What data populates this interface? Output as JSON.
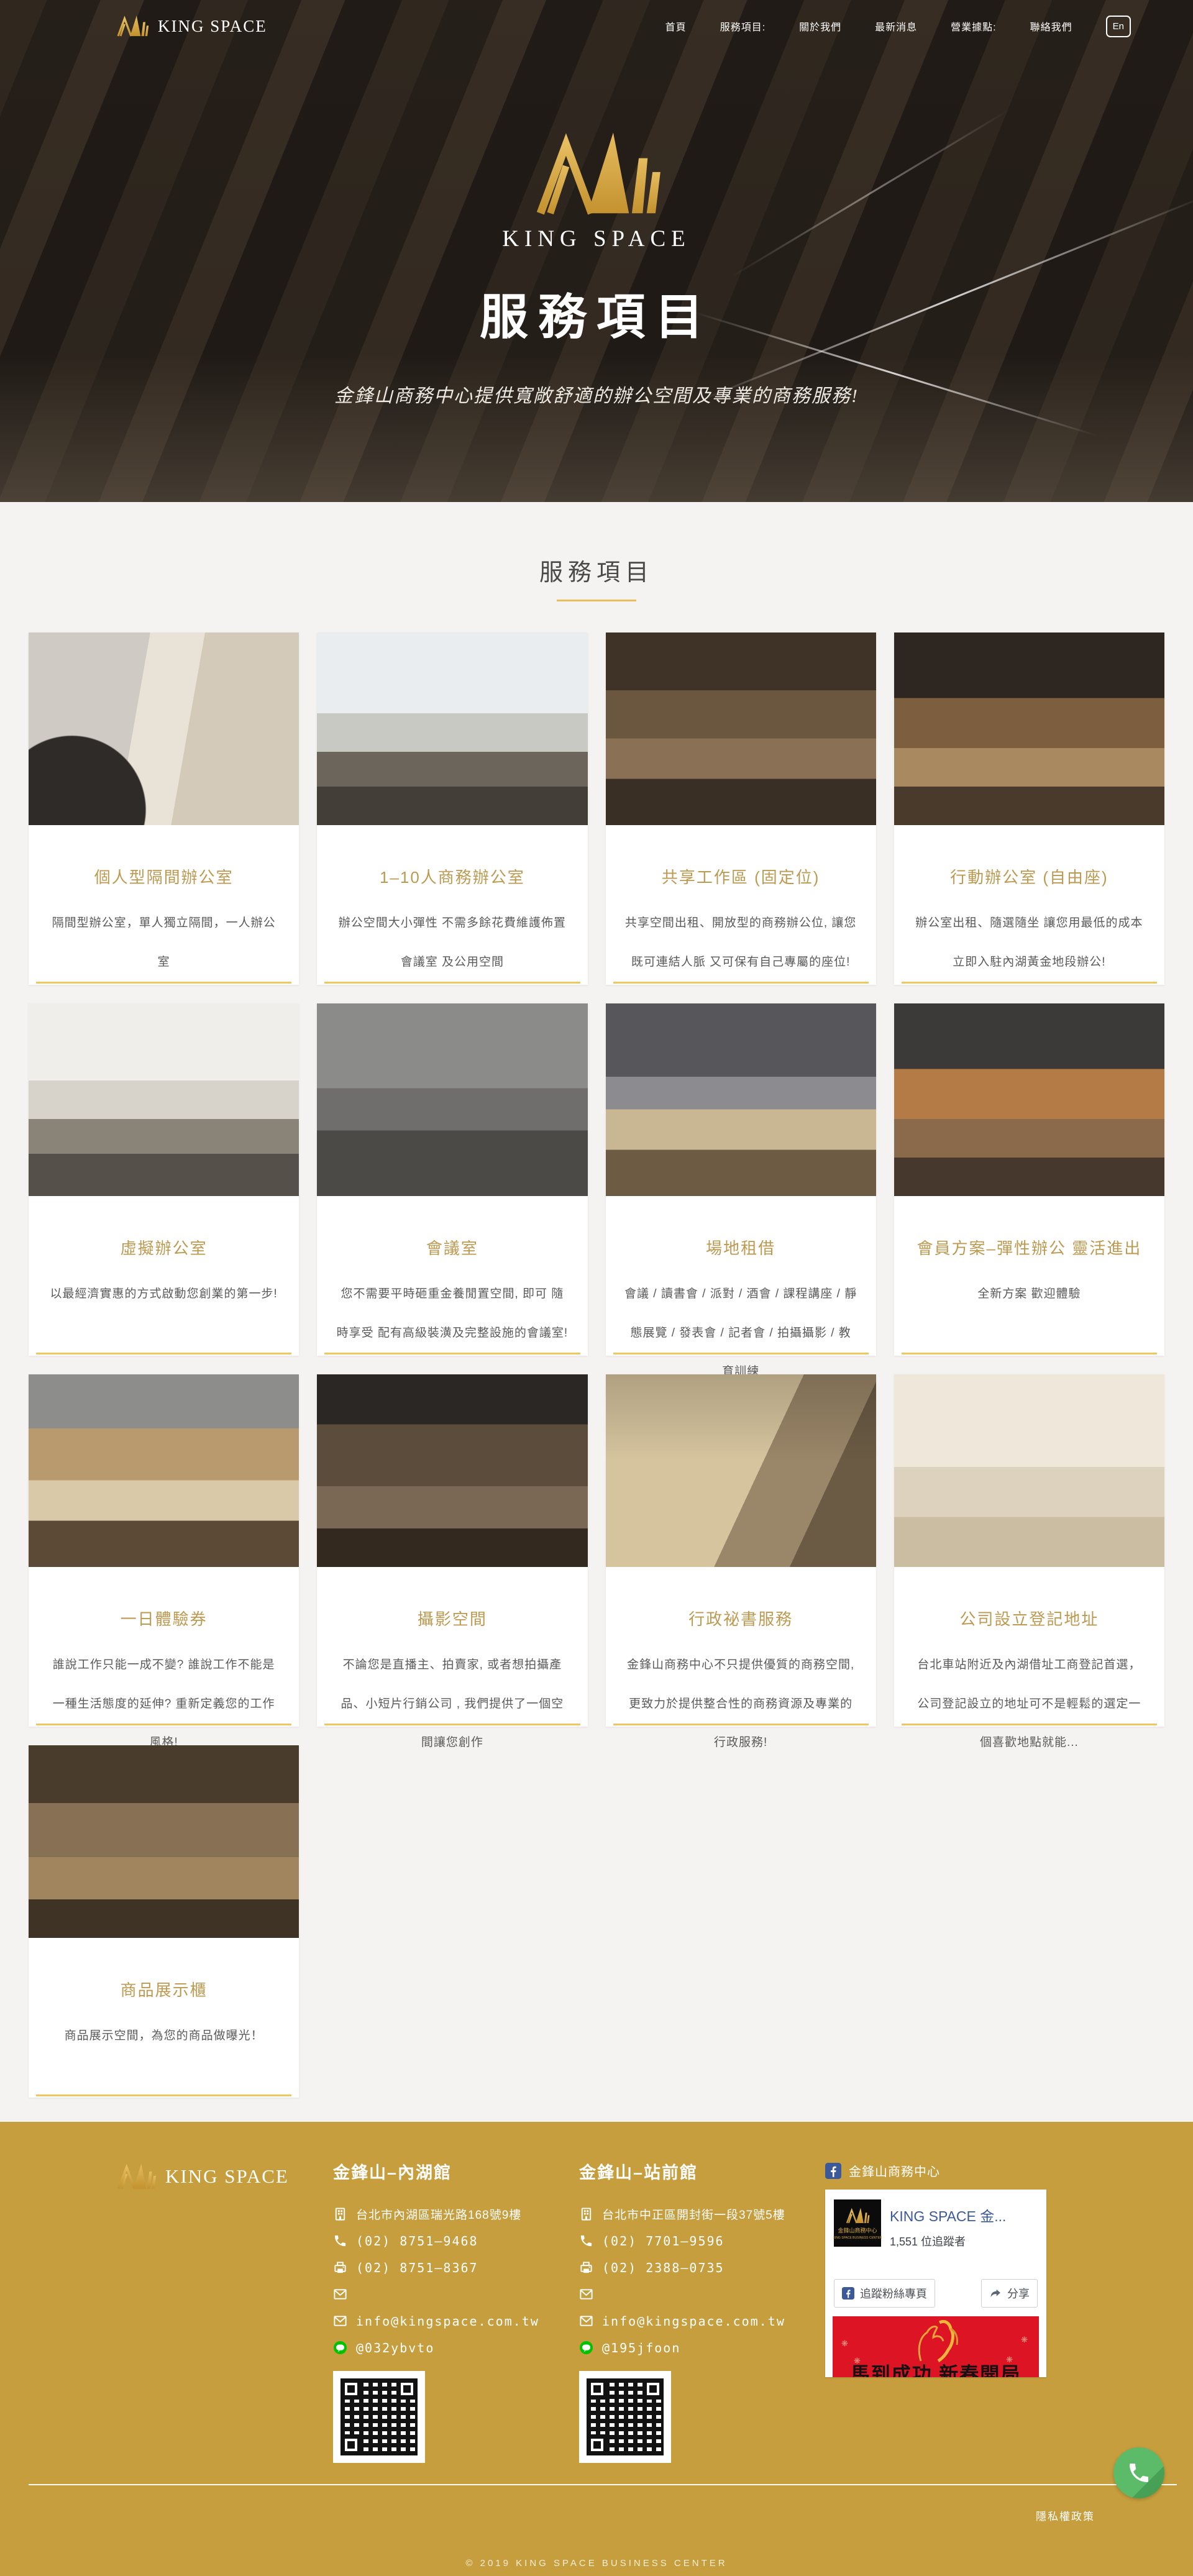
{
  "nav": {
    "brand": "KING SPACE",
    "items": [
      "首頁",
      "服務項目:",
      "關於我們",
      "最新消息",
      "營業據點:",
      "聯絡我們"
    ],
    "lang_button": "En"
  },
  "hero": {
    "brand": "KING SPACE",
    "title": "服務項目",
    "subtitle": "金鋒山商務中心提供寬敞舒適的辦公空間及專業的商務服務!"
  },
  "services": {
    "section_title": "服務項目",
    "cards": [
      {
        "title": "個人型隔間辦公室",
        "desc": "隔間型辦公室，單人獨立隔間，一人辦公室"
      },
      {
        "title": "1–10人商務辦公室",
        "desc": "辦公空間大小彈性 不需多餘花費維護佈置會議室 及公用空間"
      },
      {
        "title": "共享工作區 (固定位)",
        "desc": "共享空間出租、開放型的商務辦公位, 讓您既可連結人脈 又可保有自己專屬的座位!"
      },
      {
        "title": "行動辦公室 (自由座)",
        "desc": "辦公室出租、隨選隨坐 讓您用最低的成本 立即入駐內湖黃金地段辦公!"
      },
      {
        "title": "虛擬辦公室",
        "desc": "以最經濟實惠的方式啟動您創業的第一步!"
      },
      {
        "title": "會議室",
        "desc": "您不需要平時砸重金養閒置空間, 即可 隨時享受 配有高級裝潢及完整設施的會議室!"
      },
      {
        "title": "場地租借",
        "desc": "會議 / 讀書會 / 派對 / 酒會 / 課程講座 / 靜態展覽 / 發表會 / 記者會 / 拍攝攝影 / 教育訓練"
      },
      {
        "title": "會員方案–彈性辦公 靈活進出",
        "desc": "全新方案 歡迎體驗"
      },
      {
        "title": "一日體驗券",
        "desc": "誰說工作只能一成不變? 誰說工作不能是一種生活態度的延伸? 重新定義您的工作風格!"
      },
      {
        "title": "攝影空間",
        "desc": "不論您是直播主、拍賣家, 或者想拍攝產品、小短片行銷公司 , 我們提供了一個空間讓您創作"
      },
      {
        "title": "行政祕書服務",
        "desc": "金鋒山商務中心不只提供優質的商務空間, 更致力於提供整合性的商務資源及專業的行政服務!"
      },
      {
        "title": "公司設立登記地址",
        "desc": "台北車站附近及內湖借址工商登記首選，公司登記設立的地址可不是輕鬆的選定一個喜歡地點就能..."
      },
      {
        "title": "商品展示櫃",
        "desc": "商品展示空間，為您的商品做曝光！"
      }
    ]
  },
  "footer": {
    "brand": "KING SPACE",
    "locations": [
      {
        "name": "金鋒山–內湖館",
        "address": "台北市內湖區瑞光路168號9樓",
        "phone": "(02) 8751–9468",
        "fax": "(02) 8751–8367",
        "email": "info@kingspace.com.tw",
        "line_id": "@032ybvto"
      },
      {
        "name": "金鋒山–站前館",
        "address": "台北市中正區開封街一段37號5樓",
        "phone": "(02) 7701–9596",
        "fax": "(02) 2388–0735",
        "email": "info@kingspace.com.tw",
        "line_id": "@195jfoon"
      }
    ],
    "facebook": {
      "page_title": "金鋒山商務中心",
      "card_title": "KING SPACE 金...",
      "followers": "1,551 位追蹤者",
      "thumb_label": "金鋒山商務中心",
      "thumb_sub": "KING SPACE BUSINESS CENTER",
      "follow_button": "追蹤粉絲專頁",
      "share_button": "分享",
      "banner_text": "馬到成功  新春開局"
    },
    "privacy_link": "隱私權政策",
    "copyright": "© 2019 KING SPACE BUSINESS CENTER"
  },
  "colors": {
    "footer_gold": "#C69E3E",
    "card_accent_gold": "#EFC75E",
    "card_title_gold": "#BD9A51",
    "logo_gold": "#D8A93F",
    "facebook_blue": "#3C5A99",
    "line_green": "#00C300",
    "fab_green": "#5CBB69",
    "banner_red": "#DC1423"
  }
}
